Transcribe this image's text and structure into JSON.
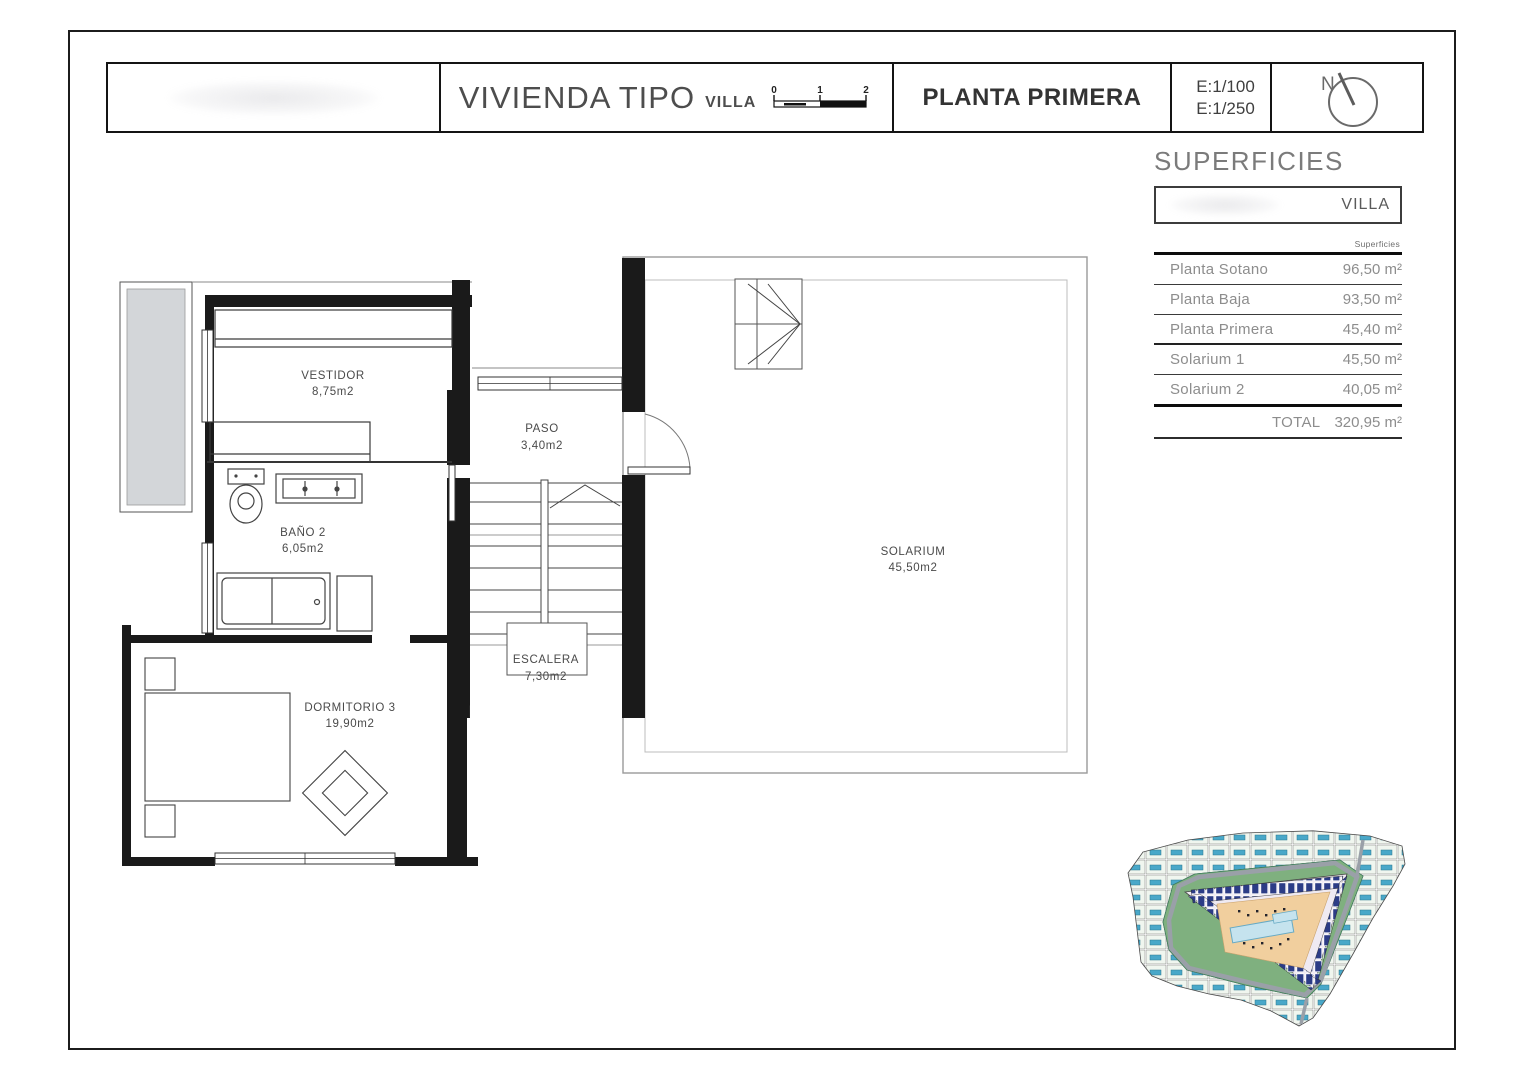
{
  "title_block": {
    "project_title": "VIVIENDA TIPO",
    "project_subtitle": "VILLA",
    "scale_ticks": [
      "0",
      "1",
      "2"
    ],
    "plan_name": "PLANTA PRIMERA",
    "scale_1": "E:1/100",
    "scale_2": "E:1/250",
    "north_label": "N"
  },
  "superficies": {
    "title": "SUPERFICIES",
    "unit_name": "VILLA",
    "column_header": "Superficies",
    "rows": [
      {
        "label": "Planta Sotano",
        "value": "96,50 m²"
      },
      {
        "label": "Planta Baja",
        "value": "93,50 m²"
      },
      {
        "label": "Planta Primera",
        "value": "45,40 m²"
      },
      {
        "label": "Solarium 1",
        "value": "45,50 m²"
      },
      {
        "label": "Solarium 2",
        "value": "40,05 m²"
      }
    ],
    "total_label": "TOTAL",
    "total_value": "320,95 m²"
  },
  "floor_plan": {
    "rooms": {
      "vestidor": {
        "name": "VESTIDOR",
        "area": "8,75m2"
      },
      "paso": {
        "name": "PASO",
        "area": "3,40m2"
      },
      "bano2": {
        "name": "BAÑO 2",
        "area": "6,05m2"
      },
      "dormitorio3": {
        "name": "DORMITORIO 3",
        "area": "19,90m2"
      },
      "escalera": {
        "name": "ESCALERA",
        "area": "7,30m2"
      },
      "solarium": {
        "name": "SOLARIUM",
        "area": "45,50m2"
      }
    }
  },
  "colors": {
    "wall": "#1a1a1a",
    "thin_line": "#666666",
    "terrace_fill": "#d3d6d9",
    "table_text": "#8d8d8d",
    "site_pool_blue": "#49a8c9",
    "site_house_blue": "#2c3c86",
    "site_road_gray": "#9aa0a8",
    "site_green": "#7fb07f",
    "site_courtyard_tan": "#f1cf9e"
  }
}
